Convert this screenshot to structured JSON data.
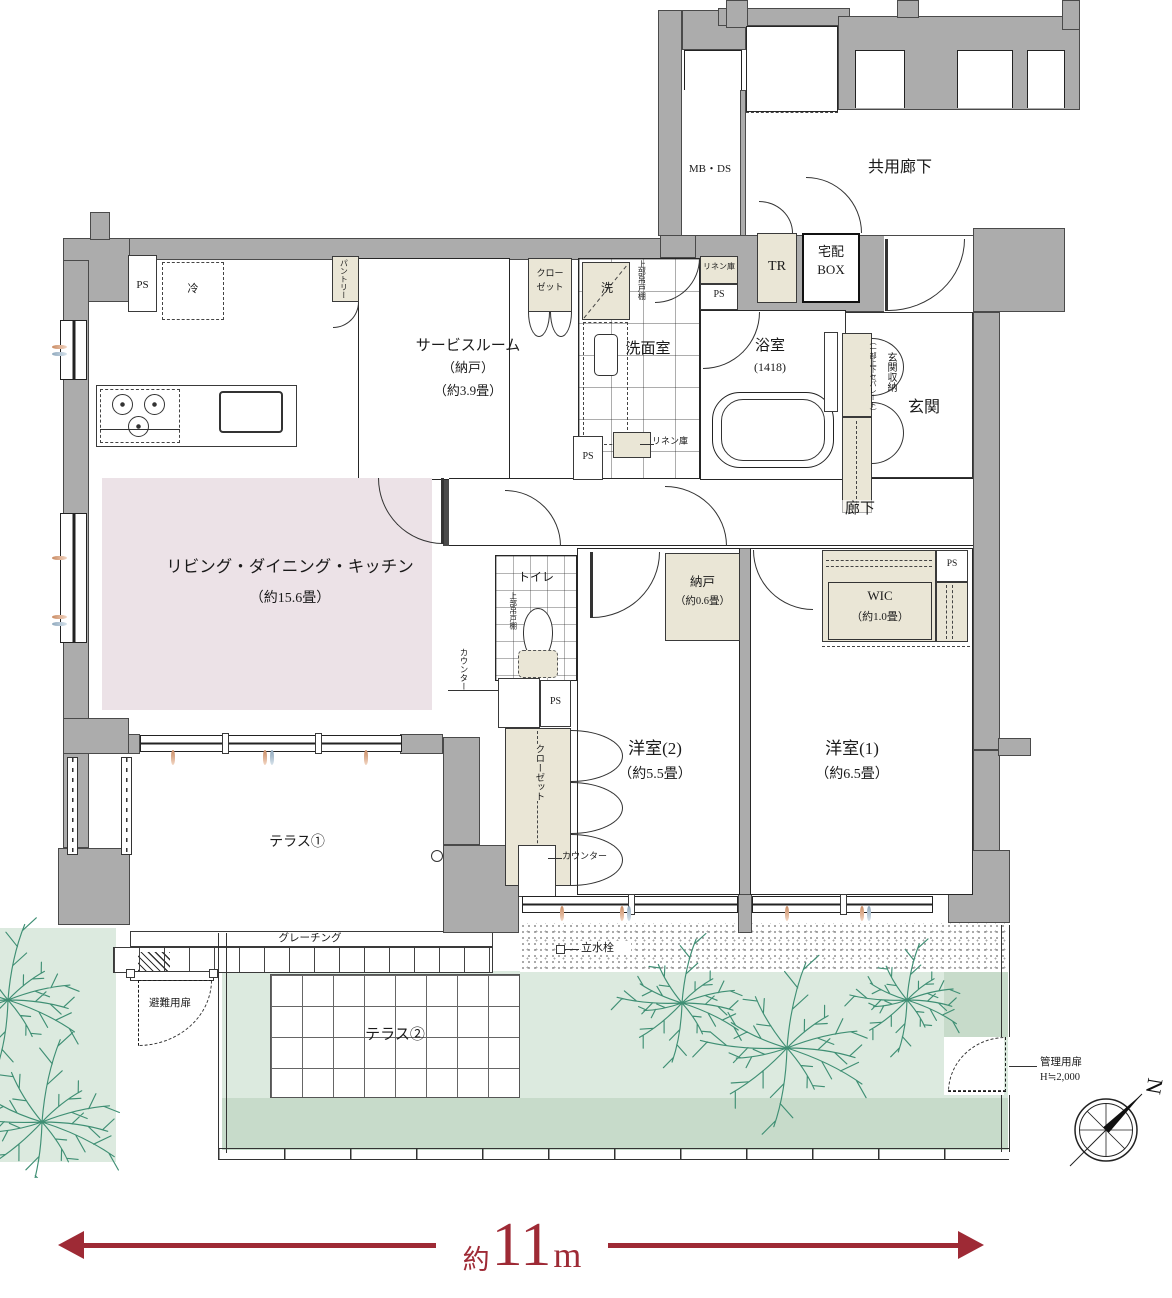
{
  "plan": {
    "common": {
      "mb_ds": "MB・DS",
      "kyoyo_roka": "共用廊下",
      "tr": "TR",
      "takuhai_line1": "宅配",
      "takuhai_line2": "BOX"
    },
    "rooms": {
      "service_name": "サービスルーム",
      "service_alt": "（納戸）",
      "service_area": "（約3.9畳）",
      "ldk_name": "リビング・ダイニング・キッチン",
      "ldk_area": "（約15.6畳）",
      "senmen": "洗面室",
      "bath_name": "浴室",
      "bath_size": "(1418)",
      "genkan": "玄関",
      "roka": "廊下",
      "toilet": "トイレ",
      "nando_name": "納戸",
      "nando_area": "（約0.6畳）",
      "wic_name": "WIC",
      "wic_area": "（約1.0畳）",
      "yoshitsu2_name": "洋室(2)",
      "yoshitsu2_area": "（約5.5畳）",
      "yoshitsu1_name": "洋室(1)",
      "yoshitsu1_area": "（約6.5畳）",
      "terrace1": "テラス①",
      "terrace2": "テラス②"
    },
    "labels": {
      "ps": "PS",
      "rei": "冷",
      "pantry": "パントリー",
      "closet_l1": "クロー",
      "closet_l2": "ゼット",
      "closet": "クローゼット",
      "sen": "洗",
      "jobu_tsuridona": "上部吊戸棚",
      "linen": "リネン庫",
      "genkan_shuno": "玄関収納",
      "genkan_shuno_note": "（一部上下セパレート）",
      "counter": "カウンター",
      "grating": "グレーチング",
      "hinan_tobira": "避難用扉",
      "rissui_sen": "立水栓",
      "kanri_tobira": "管理用扉",
      "kanri_height": "H≒2,000"
    },
    "compass": {
      "north": "N"
    },
    "dimension": {
      "prefix": "約",
      "value": "11",
      "unit": "m"
    }
  },
  "garden": {
    "trees": [
      {
        "x": 682,
        "y": 1003,
        "r": 66
      },
      {
        "x": 787,
        "y": 1048,
        "r": 88
      },
      {
        "x": 907,
        "y": 1000,
        "r": 58
      },
      {
        "x": 8,
        "y": 1000,
        "r": 78
      },
      {
        "x": 42,
        "y": 1122,
        "r": 85
      }
    ]
  }
}
